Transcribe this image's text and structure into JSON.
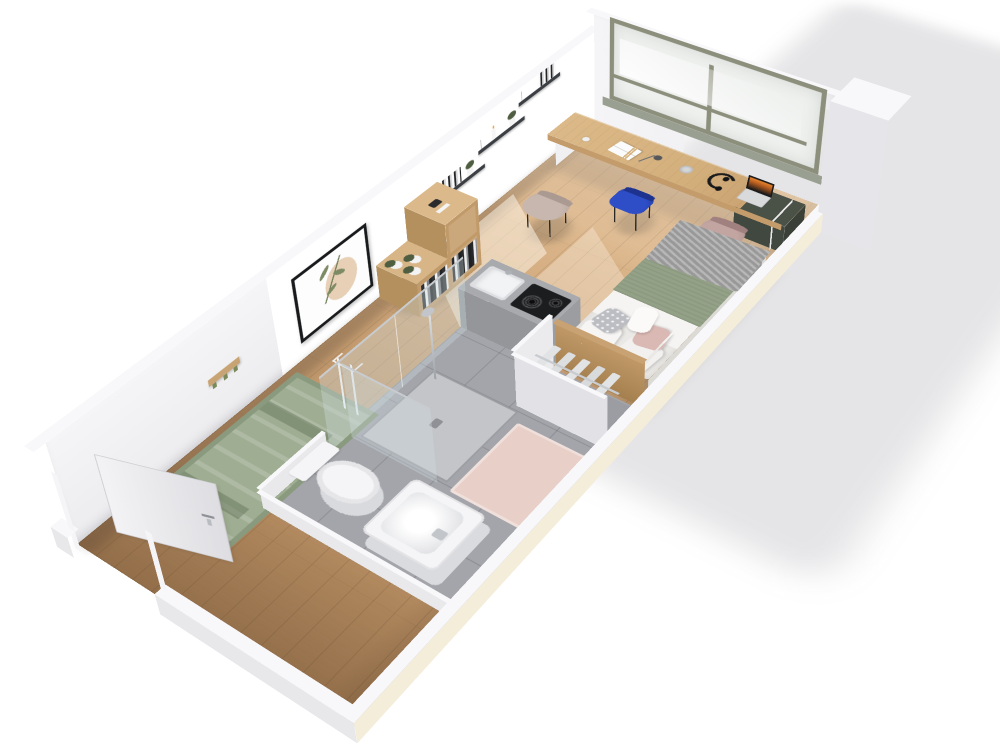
{
  "scene": {
    "type": "3d-floor-plan-render",
    "description": "Axonometric cutaway render of a furnished studio apartment on a white background",
    "rooms": [
      {
        "id": "main-room",
        "label": "Living and sleeping area",
        "floor": "oak plank"
      },
      {
        "id": "bathroom",
        "label": "Bathroom with shower, toilet and basin",
        "floor": "grey tile"
      },
      {
        "id": "entry",
        "label": "Entry with open door",
        "floor": "oak plank"
      }
    ]
  },
  "labels": {
    "window": "Window with sage-green frame",
    "desk": "Oak desk along the window",
    "laptop": "Open laptop",
    "headphones": "Headphones",
    "book": "Open book",
    "lamp": "Desk lamp",
    "speaker": "Smart speaker",
    "chair_taupe": "Taupe desk chair",
    "chair_blue": "Blue desk chair",
    "chair_mauve": "Mauve desk chair",
    "cabinet": "Dark green under-desk cabinet",
    "bed": "Bed with green blanket, grey throw and pillows",
    "wardrobe": "Open wardrobe with hangers",
    "kitchenette": "Kitchenette counter with hob and sink",
    "towels": "Pink towels in niche",
    "shower": "Walk-in shower with glass screen",
    "toilet": "Toilet",
    "basin": "Square washbasin",
    "bathmat": "Pink bath mat",
    "rug": "Sage green rug",
    "art": "Framed botanical print",
    "shelves": "Floating wall shelves with books and plants",
    "coatrack": "Wooden coat rack with green hooks",
    "cubeshelf": "Wooden cube shelving with plants",
    "towelstand": "White towel stand",
    "door": "Open entrance door",
    "column": "Corner pillar"
  },
  "colors": {
    "floor-wood": "#c79e72",
    "floor-wood-light": "#ddb78c",
    "floor-wood-dark": "#aa8157",
    "bath-tile": "#a3a5aa",
    "bath-tile-light": "#c3c5c8",
    "wall-face": "#ececef",
    "wall-shade": "#dcdce1",
    "wall-top": "#f8f8fa",
    "wall-cream": "#f4edda",
    "window-frame": "#8b8f7b",
    "window-glass": "#eef0ee",
    "sill": "#9aa091",
    "desk-wood": "#dcb988",
    "desk-wood-dark": "#c49c6b",
    "cabinet-green": "#4a5146",
    "chair-taupe": "#c7b7ae",
    "chair-blue": "#2e4ec8",
    "chair-mauve": "#c2a4a1",
    "chair-leg": "#2b2825",
    "bed-linen": "#ebe9e6",
    "sheet-white": "#f5f4f2",
    "blanket-green": "#93a187",
    "throw-gray": "#a5a4a4",
    "pillow-pink": "#dab8b3",
    "pillow-dot": "#bcbdc2",
    "headboard": "#b98f60",
    "rug-green": "#9fad92",
    "rug-dark": "#8a9a7e",
    "mat-pink": "#e8cfc8",
    "towel-pink": "#e3c2bb",
    "shelf-dark": "#3b3f43",
    "plant-green": "#4f5e40",
    "pot-white": "#f3f3f3",
    "frame-black": "#191a1c",
    "art-beige": "#e7d0b6",
    "art-olive": "#7d8a63",
    "chrome": "#c8cbcf",
    "cooktop-black": "#1c1d1f",
    "counter-gray": "#a8aaae",
    "counter-front": "#b9bbbe",
    "door-white": "#f2f2f4",
    "fixture-white": "#f5f5f7",
    "glass-tint": "rgba(205,220,224,0.35)"
  }
}
